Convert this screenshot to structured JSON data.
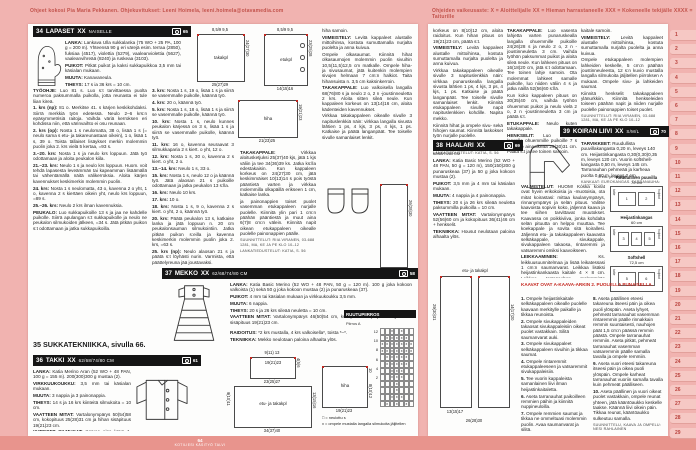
{
  "header": {
    "credit_left": "Ohjeet kokosi Pia Maria Pekkanen. Ohjekuvitukset: Leeni Hoimela, leeni.hoimela@otavamedia.com",
    "difficulty_legend": "Ohjeiden vaikeusaste:  X = Aloittelijalle   XX = Hieman harrastaneelle   XXX = Kokeneelle tekijälle   XXXX = Taiturille"
  },
  "footer": {
    "page_number": "64",
    "magazine": "KOTILIESI KÄSITYÖ TALVI"
  },
  "tabs": [
    "1",
    "2",
    "3",
    "4",
    "5",
    "6",
    "7",
    "8",
    "9",
    "10",
    "11",
    "12",
    "13",
    "14",
    "15",
    "16",
    "17",
    "18",
    "19",
    "20",
    "21",
    "22",
    "23",
    "24",
    "25",
    "26",
    "27",
    "28",
    "29"
  ],
  "s34": {
    "num": "34",
    "title": "LAPASET",
    "diff": "XX",
    "audience": "NAISELLE",
    "photo": "65",
    "info": [
      {
        "b": "LANKA:",
        "t": " Lankava Ulla sukkalanka (75 WO + 25 PA, 100 g = 200 m). Yhteensä 90 g eri värejä esim. terraa (2850), fuksiaa (4517), violettia (5279), vaaleanviolettia (5627), vaaleanvihreää (8240) ja ruskeaa (3103)."
      },
      {
        "b": "PUIKOT:",
        "t": " Pitkät puikot ja kaksi sukkapuikkoa 3,5 mm tai käsialan mukaan."
      },
      {
        "b": "MUUTA:",
        "t": " Kanavaneula."
      },
      {
        "b": "TIHEYS:",
        "t": " 17 s ja 36 krs = 10 cm."
      },
      {
        "b": "TEKNIIKKA:",
        "t": " Lapaset neulotaan sivuttain."
      }
    ],
    "col1": [
      {
        "b": "TYÖOHJE:",
        "t": " Luo 81 s. Luo s:t tarvittaessa puolta numeroa paksummalla puikolla, jotta reunasta ei tule liian kireä."
      },
      {
        "b": "1. krs (np):",
        "t": " 81 o. Merkitse 41. s kärjen keskikohdaksi. Siirrä merkkiä työn edetessä. Neulo 2–6 krs:n epäsymmetrisiä raitoja. Vaihda väriä kerroksen eri kohdissa niin, että värinvaihto ei osu reunaan."
      },
      {
        "b": "2. krs (op):",
        "t": " Nosta 1 s neulomatta, 38 o, lisää 1 s (= neulo sama s etu- ja takareunastaan oikein), 1 o, lisää 1 s, 39 o. Toista tällaiset lisäykset merkin molemmin puolin joka 2. krs vielä 5 kertaa, =93 s."
      },
      {
        "b": "3.–20. krs:",
        "t": " Nosta 1 s ja neulo krs loppuun. Jätä työ odottamaan ja aloita peukalon kiila."
      },
      {
        "b": "21.–23. krs:",
        "t": " Neulo 1 s ja neulo krs loppuun. Huom. voit tehdä lapasesta leveämmän tai kapeamman lisäämällä tai vähentämällä näitä välikerroksia. Aloita kärjen kavennukset keskimerkin molemmin puolin."
      },
      {
        "b": "24. krs:",
        "t": " Nosta 1 s neulomatta, 43 o, kavenna 2 o yht, 1 o, kavenna 2 s kiertäen oikein yht, neulo krs loppuun, =89 s."
      },
      {
        "b": "25.–26. krs:",
        "t": " Neulo 2 krs ilman kavennuksia."
      },
      {
        "b": "PEUKALO:",
        "t": " Luo sukkapuikoille 13 s ja jaa ne kahdelle puikolle. Siirrä apulangan s:t sukkapuikolle ja neulo ne peukalon silmukoiden jälkeen, =34 s. Jätä pitkän puikon s:t odottamaan ja jatka sukkapuikoilla."
      }
    ],
    "col2": [
      {
        "b": "3. krs:",
        "t": " Nosta 1 s, 19 o, lisää 1 s ja siirrä se vasemmalle puikolle, käännä työ."
      },
      {
        "b": "4. krs:",
        "t": " 20 o, käännä työ."
      },
      {
        "b": "5. krs:",
        "t": " Nosta 1 s, 18 o, lisää 1 s ja siirrä se vasemmalle puikolle, käännä työ."
      },
      {
        "b": "10. krs:",
        "t": " Nosta 1 s, neulo kunnes peukalon kärjessä on 3 s, lisää 1 s ja siirrä se vasemmalle puikolle, käännä työ."
      },
      {
        "b": "11. krs:",
        "t": " 16 o, kavenna seuraavat 3 silmukkaparia 2 s kiert. o yht, 12 o."
      },
      {
        "b": "12. krs:",
        "t": " Nosta 1 s, 30 o, kavenna 2 s kiert. o yht, 2 o."
      },
      {
        "b": "13.–14. krs:",
        "t": " Neulo 1 s, 33 o."
      },
      {
        "b": "15. krs:",
        "t": " Nosta 1 s, neulo 12 o ja käännä työ. Jätä alaosan 21 s puikoille odottamaan ja jatka peukalon 13 s:lla."
      },
      {
        "b": "16. krs:",
        "t": " Neulo 10 krs."
      },
      {
        "b": "17. krs:",
        "t": " 10 o."
      },
      {
        "b": "18. krs:",
        "t": " Nosta 1 s, 9 o, kavenna 2 s kiert. o yht, 2 o, käännä työ."
      },
      {
        "b": "20. krs:",
        "t": " Päätä peukalon 13 s, katkaise lanka ja jätä loppuun n. 20 cm peukalonsauman silmukointiin. Jatka pitkän puikon s:eilla ja kavenna keskimerkin molemmin puolin joka 2. krs, =63 s."
      },
      {
        "b": "25. krs (np):",
        "t": " Neulo alaosan 21 s ja päätä s:t löyhästi nurin. Varmista, että päättelyreuna jää joustavaksi."
      },
      {
        "t": "Neulo oikean käden lapanen samoin, mutta käännä nyt nurja puoli lapasen oikeaksi puoleksi, jolloin peukalo tulee toiseen reunaan. Ota tämä huomioon raidoituksessa."
      }
    ]
  },
  "s35": {
    "heading": "35 SUKKATEKNIIKKA, sivulla 66."
  },
  "s36": {
    "num": "36",
    "title": "TAKKI",
    "diff": "XX",
    "sizes": "62/68/74/80 CM",
    "photo": "61",
    "info": [
      {
        "b": "LANKA:",
        "t": " Katia Merino Aran (52 WO + 48 PAN, 100 g = 155 m). 200(300)300 g mustaa (2)."
      },
      {
        "b": "VIRKKUUKOUKKU:",
        "t": " 3,5 mm tai käsialan mukaan."
      },
      {
        "b": "MUUTA:",
        "t": " 3 nappia ja 3 painonappia."
      },
      {
        "b": "TIHEYS:",
        "t": " 14 s ja 16 krs kiinteitä silmukoita = 10 cm."
      },
      {
        "b": "VAATTEEN MITAT:",
        "t": " Vartalonympärys 50(54)58 cm, kokopituus 25(28)31 cm ja hihan sisäpituus 19(21)23 cm."
      },
      {
        "b": "YHTEISET SILMUKAT:",
        "t": " Korvaa aina krs:n 1. kiinteä silmukka (ks) 1 ketjusilmukalla."
      },
      {
        "b": "TEKNIIKKA:",
        "t": " Jakku virkataan paloina alhaalta ylös."
      }
    ],
    "col3": [
      {
        "b": "TAKAKAPPALE:",
        "t": " Virkkaa aloitusketjuksi 25(37)40 kjs, jätä 1 kjs väliin ja tee 34(36)39 ks. Jatka ks:lla edestakaisin. Kun kappaleen korkeus on 24(27)30 cm, jätä keskimmäiset 10(13)14 s pois työstä pääntietä varten ja virkkaa molemmilla olkapäillä erikseen 1 cm, katkaise lanka."
      },
      {
        "t": "ja painonappien toiset puolet vasemman etukappaleen nurjalle puolelle. Kiinnitä ylin pari 1 cm:n päähän pääntiestä ja muut aina 6(7)8 cm:n välein. Kiinnitä napit oikean etukappaleen oikealle puolelle painonappien päälle."
      },
      {
        "sc": "SUUNNITTELUT: RIIA VIRANEN, 03-688 1281, MA, KE JA PE KLO 10–12"
      },
      {
        "sc": "LANKATIEDUSTELUT: KATIA, S. 56"
      }
    ],
    "col4": [
      {
        "t": "hiha samoin."
      },
      {
        "b": "VIIMEISTELY:",
        "t": " Levitä kappaleet alustalle mittoihinsa, kostuta sumuttamalla nurjalta puolelta ja anna kuivua."
      },
      {
        "t": "Ompele olkasaumat. Kiinnitä hihat olkasaumojen molemmin puolin sivuihin 10,5(11,5)12,5 cm matkalle. Ompele hiha- ja sivusaumat, jätä kuitenkin molempien sivujen helmaan 7 cm:n halkiot. Taita hihansuista n. 3,5 cm kaksinkerroin."
      },
      {
        "b": "TAKAKAPPALE:",
        "t": " Luo valkoisella langalla 68(76)80 s ja neulo 2 o, 2 n -joustinneuletta 2 krs. Aloita sitten sileä neule. Kun kappaleen korkeus on 13(14)16 cm, aloita kädenteiden kavennukset."
      },
      {
        "t": "Virkkaa takakappaleen oikealle sivulle 3 napituslenkkiä näin: virkkaa langalla sivusta lähtien 1 ps, 4 kjs, 3 ps, 4 kjs, 1 ps. Katkaise ja päätä langanpäät. Tee toiselle sivulle samanlaiset lenkit."
      }
    ],
    "schem": {
      "takakpl": {
        "name": "takakpl",
        "top": "8,5/9   9,5",
        "right": "24(27)30",
        "bottom": "25(27)29"
      },
      "etukpl": {
        "name": "etukpl",
        "top1": "8,5/9  9,5",
        "top2": "5,5/6  6,5",
        "right": "23(25)28",
        "bottom": "14(15)16"
      },
      "hiha": {
        "name": "hiha",
        "right": "19(21)23",
        "bottom": "21(23)25"
      }
    }
  },
  "s37": {
    "num": "37",
    "title": "MEKKO",
    "diff": "XX",
    "sizes": "62/68/74/80 CM",
    "photo": "58",
    "info": [
      {
        "b": "LANKA:",
        "t": " Katia Basic Merino (52 WO + 48 PAN, 50 g = 120 m). 100 g joka kokoon valkoista (1) sekä 50 g joka kokoon mustaa (2) ja punaruskeaa (37)."
      },
      {
        "b": "PUIKOT:",
        "t": " 4 mm tai käsialan mukaan ja virkkuukoukku 3,5 mm."
      },
      {
        "b": "MUUTA:",
        "t": " 6 nappia."
      },
      {
        "b": "TIHEYS:",
        "t": " 20 s ja 26 krs sileää neuletta = 10 cm."
      },
      {
        "b": "VAATTEEN MITAT:",
        "t": " Vartalonympärys 46(50)54 cm, kokopituus 40(44)48 cm ja hihan sisäpituus 19(21)23 cm."
      }
    ],
    "extra": [
      {
        "b": "RAIDOITUS:",
        "t": " *2 krs mustalla, 4 krs valkoisella*, toista *–*."
      },
      {
        "b": "TEKNIIKKA:",
        "t": " Mekko neulotaan paloina alhaalta ylös."
      }
    ],
    "cont": [
      {
        "t": "korkeus on 8(10)12 cm, aloita raidoitus. Kun hihan pituus on 19(21)23 cm, päätä s:t."
      },
      {
        "b": "VIIMEISTELY:",
        "t": " Levitä kappaleet alustalle mittoihinsa, kostuta sumuttamalla nurjalta puolelta ja anna kuivua."
      },
      {
        "t": "Virkkaa takakappaleen oikealle sivulle 3 napituslenkkiä näin: virkkaa punaruskealla langalla sivusta lähtien 1 ps, 4 kjs, 3 ps, 4 kjs, 1 ps. Katkaise ja päätä langanpäät. Tee toiselle sivulle samanlaiset lenkit. Kiinnitä etukappaleen sivulle napit napituslenkkien kohdille. Napita mekko."
      },
      {
        "t": "Kiinnitä hihat ja ompele sivu- sekä hihojen saumat. Kiinnitä laskokset työn nurjalle puolelle."
      },
      {
        "sc": "SUUNNITTELUT: RIIA VIRANEN, 03-688 1281, MA, KE JA PE KLO 10–12"
      },
      {
        "sc": "LANKATIEDUSTELUT: KATIA, S. 56"
      }
    ],
    "schem": {
      "etu_takakpl": {
        "name": "etu- ja takakpl",
        "top": "9(11) 13",
        "yoke": "19(21)23",
        "mid": "23(25)27",
        "bottom": "34(37)40",
        "left": "9(10)11",
        "right_top": "4(5)6",
        "right_bottom": "13(15)16"
      },
      "hiha": {
        "name": "hiha",
        "right_top": "10",
        "right_bottom": "8(10)12",
        "bottom": "19(21)23"
      },
      "extra": {
        "right": "26(28)30",
        "bottom": "12(13)14"
      }
    },
    "ruutu": {
      "title": "RUUTUPIIRROS",
      "caption": "Piirros A",
      "row_labels": [
        "12",
        "10",
        "8",
        "6",
        "4",
        "2"
      ],
      "rows": [
        "..x.x..",
        ".xxxxx.",
        "xxxxxxx",
        "xxxxxxx",
        ".xxxxx.",
        ".xxxxx.",
        "..xxx..",
        "..xxx..",
        "...x...",
        "...x...",
        "..xxx..",
        ".x.x.x."
      ],
      "legend": [
        {
          "t": "□ = neulottu s"
        },
        {
          "t": "x = ompele mustalla langalla silmukoita jäljitellen"
        }
      ]
    }
  },
  "s38": {
    "num": "38",
    "title": "HAALARI",
    "diff": "XX",
    "sizes": "62/68/74/80 CM",
    "photo": "69",
    "info": [
      {
        "b": "LANKA:",
        "t": " Katia Basic Merino (52 WO + 48 PAN, 50 g = 120 m), 150(150)200 g punaruskeaa (37) ja 50 g joka kokoon mustaa (2)."
      },
      {
        "b": "PUIKOT:",
        "t": " 3,5 mm ja 4 mm tai käsialan mukaan."
      },
      {
        "b": "MUUTA:",
        "t": " 4 nappia ja 4 painonappia."
      },
      {
        "b": "TIHEYS:",
        "t": " 20 s ja 26 krs sileää neuletta paksummilla puikoilla = 10 cm."
      },
      {
        "b": "VAATTEEN MITAT:",
        "t": " Vartalonympärys 52(56)60 cm ja kokopituus 36(41)46 cm + henkselit."
      },
      {
        "b": "TEKNIIKKA:",
        "t": " Housut neulotaan paloina alhaalta ylös."
      }
    ],
    "col_takakappale": [
      {
        "b": "TAKAKAPPALE:",
        "t": " Luo vasenta lahjetta varten punaruskealla langalla ohuemmille puikoille 24(26)28 s ja neulo 2 o, 2 n -joustinneuletta 3 cm. Vaihda työhön paksummat puikot ja aloita sileä neule. Kun lahkeen pituus on 16(18)20 cm, jätä s:t odottamaan. Tee toinen lahje samoin. Ota molemmat lahkeet samalle puikolle, luo niiden väliin 4 s ja jatka näillä 52(56)60 s:llä."
      },
      {
        "t": "Kun koko kappaleen pituus on 30(35)40 cm, vaihda työhön ohuemmat puikot ja neulo vielä 2 o, 2 n -joustinneuletta 3 cm ja päätä s:t."
      },
      {
        "b": "ETUKAPPALE:",
        "t": " Neulo kuten takakappale."
      },
      {
        "b": "HENKSELIT:",
        "t": " Luo mustalla langalla ohuemmille puikoille 7 s ja neulo ainaoikeaa 29(30)31 cm. Päätä s:t ja tee toinen samoin."
      }
    ],
    "col_viimeistely": [
      {
        "t": "kaitale samoin."
      },
      {
        "b": "VIIMEISTELY:",
        "t": " Levitä kappaleet alustalle mittoihinsa, kostuta sumuttamalla nurjalta puolelta ja anna kuivua."
      },
      {
        "t": "Ompele etukappaleen molempien lahkeiden keskelle, 5 cm:n päähän joustinneuleesta, 12 s:n kuvio mustalla langalla silmukoita jäljitellen piirroksen A mukaan. Ompele sivu- ja lahkeiden saumat."
      },
      {
        "t": "Kiinnitä henkselit takakappaleen ylänurkkiin. Kiinnitä henkseleiden toiseen päähän napit ja niiden nurjalle puolelle painonappien toiset puolet."
      },
      {
        "sc": "SUUNNITTELUT: RIIA VIRANEN, 03-688 1281, MA, KE JA PE KLO 10–12"
      },
      {
        "sc": "LANKATIEDUSTELUT: KATIA, S. 56"
      }
    ],
    "schem": {
      "name": "etu- ja takakpl",
      "left": "29(30)31",
      "right": "14(17)20",
      "leg": "13(15)17",
      "bottom": "26(28)30"
    }
  },
  "s39": {
    "num": "39",
    "title": "KOIRAN LIIVI",
    "diff": "XX",
    "sizes": "S/M/L",
    "photo": "70",
    "tarvikkeet": [
      {
        "b": "TARVIKKEET:",
        "t": " Ruudullista puuvillakangasta 0,20 m, leveys 140 cm. Heijastinkangasta 0,30(0,30)0,35 m, leveys 120 cm. Vuorin softshell-kangasta 0,50 m, leveys 145 cm. Tarranauhan pehmeää ja karheaa puolta 0,60 m, leveys 2 cm."
      },
      {
        "sc": "KANKAAT: EUROKANGAS. TARRANAUHA: NAPPITALO."
      }
    ],
    "caption": "5 etu- ja takakpl",
    "valmistelut": [
      {
        "b": "VALMISTELUT:",
        "t": " HUOM! Koska koirat ovat hyvin erikokoisia ja -muotoisia, ota mitat koirastasi: mittaa kaulanympärys, rinnanympärys ja selän pituus. Valitse kaavoista sopivin koko, jäljennä kaava ja tee siihen tarvittavat muutokset. Kaavassa on poikkiviiva, jonka kohdalta selän pituutta on helppo muuttaa. Tee koekappale ja sovita sitä koirallesi. Jäljennä etu- ja takakappaleen kaavasta selkäkappale, sivukappale, sivukappaleen takaosa, rintaremmi ja vatsaremmi omiksi kaavoikseen."
      },
      {
        "b": "LEIKKAAMINEN:",
        "t": " Ks. leikkuusuunnitelmaa ja lisää leikatessasi 1 cm:n saumanvarat. Leikkaa lisäksi heijastinkankaasta kaitale 4 × 8 cm. Leikkaa tarranauhan molemmista puolista kaksi 17,5 cm:n ja kaksi 12,5 cm:n pätkää."
      }
    ],
    "cuts": [
      {
        "name": "Ruudullinen puuvilla",
        "size": "70 cm",
        "left": "taite",
        "right": "hulpiot",
        "pieces": [
          "1",
          "2"
        ]
      },
      {
        "name": "Heijastinkangas",
        "size": "60 cm",
        "left": "taite",
        "right": "hulpiot",
        "pieces": [
          "3",
          "4",
          "5"
        ]
      },
      {
        "name": "Softshell",
        "size": "72,5 cm",
        "left": "taite",
        "right": "hulpiot",
        "pieces": [
          "5",
          "6"
        ]
      }
    ],
    "red_note": "KAAVAT OVAT A-KAAVA-ARKIN 2. PUOLELLA PUNAISELLA.",
    "steps_a": [
      {
        "b": "1.",
        "t": " Ompele heijastinkaitale selkäkappaleen oikealle puolelle kaavaan merkitylle paikalle ja tikkaa reunoista."
      },
      {
        "b": "2.",
        "t": " Ompele sivukappaleiden takaosat sivukappaleisiin oikeat puolet vastakkain. Silitä saumanvarat auki."
      },
      {
        "b": "3.",
        "t": " Ompele sivukappaleet selkäkappaleen sivuihin ja tikkaa saumat."
      },
      {
        "b": "4.",
        "t": " Ompele rintaremmit etukappaleeseen ja vatsaremmit sivukappaleisiin."
      },
      {
        "b": "5.",
        "t": " Tee vuorin kappaleista samanlainen liivi ilman heijastinkaitaletta."
      },
      {
        "b": "6.",
        "t": " Aseta tarranauhat paikoilleen remmien päihin ja kiinnitä nuppineuloilla."
      },
      {
        "b": "7.",
        "t": " Ompele remmien saumat ja tikkaa ne ommeltuasi molemmin puolin. Avaa saumanvarat ja silitä."
      }
    ],
    "steps_b": [
      {
        "b": "8.",
        "t": " Aseta päällinen eteesi takareuna itseesi päin ja oikea puoli ylöspäin. Aseta lyhyet, pehmeät tarranauhat vasemman rintaremmin päälle rinnakkain remmin suuntaisesti, nauhojen päät 1,5 cm:n päässä remmin päästä. Ompele tarranauhat remmiin. Aseta pitkät, pehmeät tarranauhat vasemman vatsaremmin päälle samalla tavalla ja ompele remmiin."
      },
      {
        "b": "9.",
        "t": " Aseta vuori eteesi takareuna itseesi päin ja oikea puoli ylöspäin. Ompele karheat tarranauhat vuoriin samalla tavalla kuin pehmeät päälliseen."
      },
      {
        "b": "10.",
        "t": " Aseta päällinen ja vuori oikeat puolet vastakkain, ompele reunat yhteen, jätä kääntöaukko keskelle taakse. Käännä liivi oikein päin. Tikkaa reunat, kääntöaukko sulkeutuu samalla."
      },
      {
        "sc": "SUUNNITTELU, KAAVA JA OMPELU: NESI RAHLAINEN"
      }
    ]
  }
}
